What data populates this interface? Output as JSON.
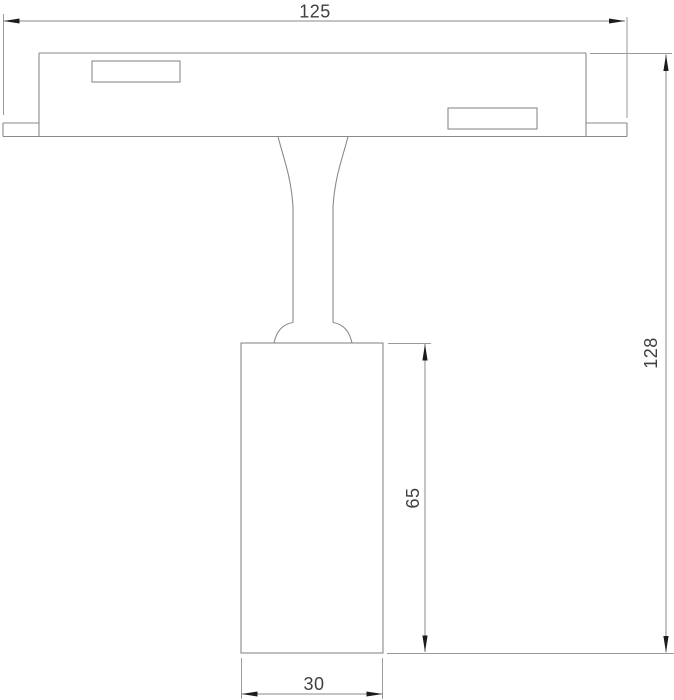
{
  "drawing": {
    "kind": "technical-dimension-drawing",
    "subject": "track-mounted-spotlight-front-view",
    "labels": {
      "overall_width": "125",
      "overall_height": "128",
      "body_height": "65",
      "body_width": "30"
    },
    "colors": {
      "background": "#ffffff",
      "line": "#8a8a8a",
      "arrow": "#1c1c1c",
      "text": "#3f3f3f"
    }
  }
}
